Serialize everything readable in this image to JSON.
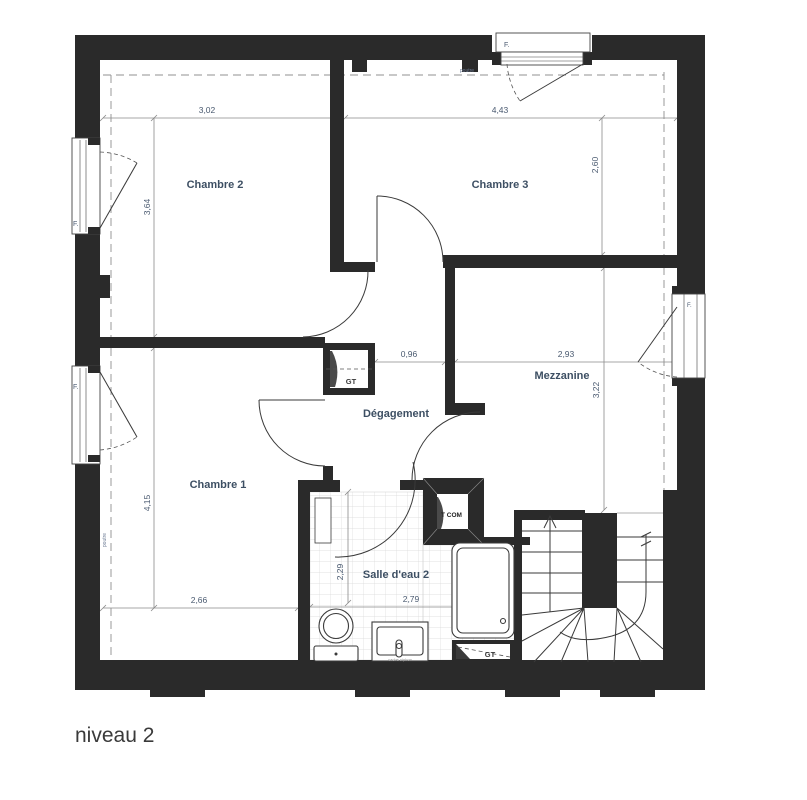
{
  "title": "niveau 2",
  "rooms": {
    "chambre2": "Chambre 2",
    "chambre3": "Chambre 3",
    "chambre1": "Chambre 1",
    "mezzanine": "Mezzanine",
    "degagement": "Dégagement",
    "salledeau2": "Salle d'eau 2"
  },
  "dims": {
    "d302": "3,02",
    "d443": "4,43",
    "d364": "3,64",
    "d260": "2,60",
    "d096": "0,96",
    "d293": "2,93",
    "d322": "3,22",
    "d415": "4,15",
    "d266": "2,66",
    "d229": "2,29",
    "d279": "2,79"
  },
  "annotations": {
    "gt": "GT",
    "com": "T COM",
    "window": "F.",
    "poutre": "poutre",
    "cache_siphon": "cache-siphon"
  },
  "colors": {
    "wall": "#2a2a2a",
    "room_label": "#3d4f63",
    "line": "#3a3a3a",
    "dash": "#909090",
    "tile": "#d8d8d8"
  }
}
